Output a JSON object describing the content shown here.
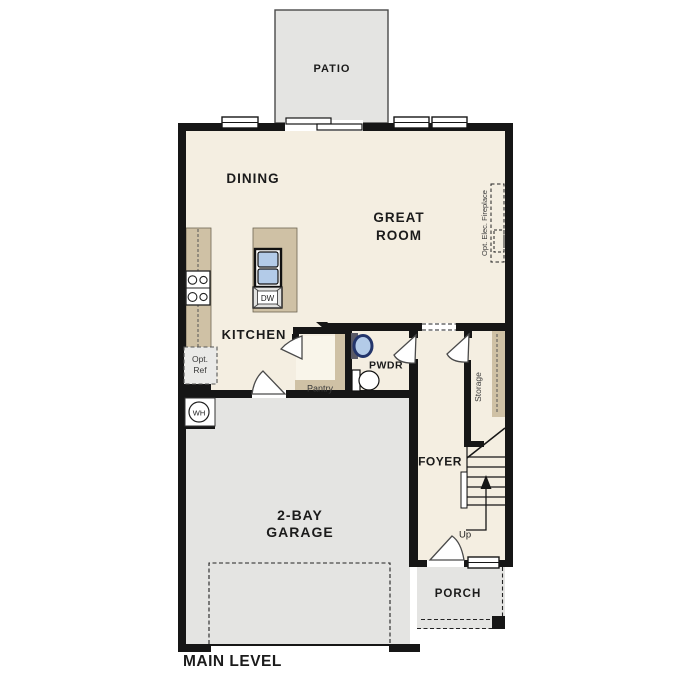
{
  "plan": {
    "title": "MAIN LEVEL",
    "rooms": {
      "patio": "PATIO",
      "dining": "DINING",
      "great1": "GREAT",
      "great2": "ROOM",
      "kitchen": "KITCHEN",
      "pwdr": "PWDR",
      "pantry": "Pantry",
      "foyer": "FOYER",
      "storage": "Storage",
      "garage1": "2-BAY",
      "garage2": "GARAGE",
      "porch": "PORCH"
    },
    "labels": {
      "up": "Up",
      "wh": "WH",
      "dw": "DW",
      "opt_ref1": "Opt.",
      "opt_ref2": "Ref",
      "fireplace": "Opt. Elec. Fireplace"
    }
  },
  "colors": {
    "floor": "#f4eee1",
    "floor_light": "#f9f5ea",
    "casework": "#cfc1a5",
    "exterior": "#e4e4e2",
    "wall": "#161616",
    "sink_blue": "#b3cbe8",
    "sink_ring": "#23356b",
    "fixture_gray": "#e2e2e0"
  }
}
